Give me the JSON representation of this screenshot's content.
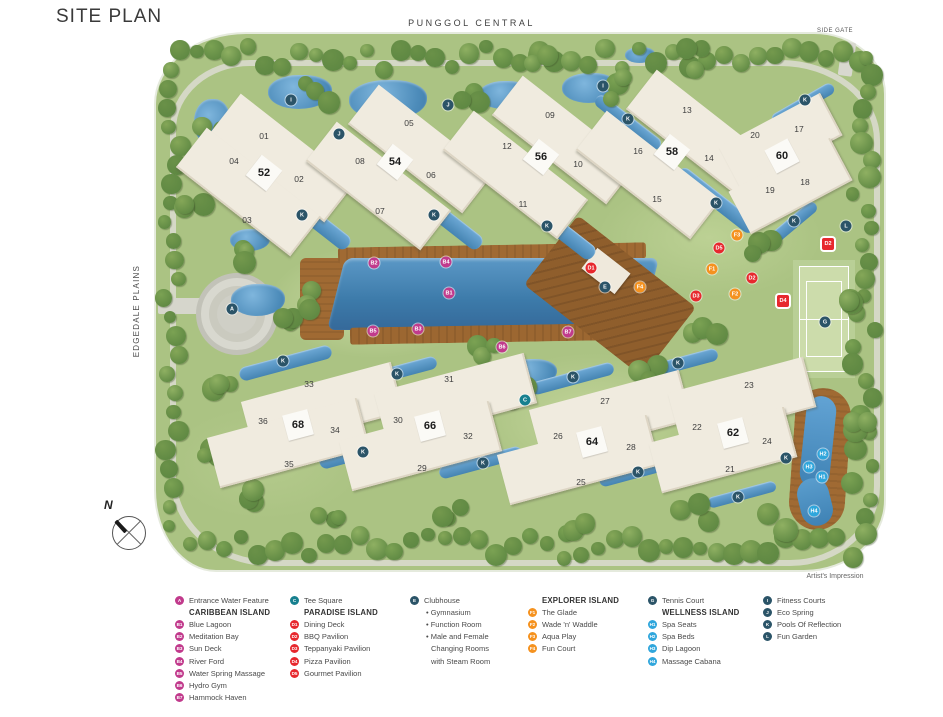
{
  "page": {
    "title": "SITE PLAN",
    "artist_note": "Artist's Impression"
  },
  "roads": {
    "top": "PUNGGOL CENTRAL",
    "left": "EDGEDALE PLAINS",
    "side_gate": "SIDE GATE"
  },
  "compass": {
    "label": "N"
  },
  "colors": {
    "pink": "#C13A8C",
    "red": "#E7282E",
    "orange": "#F5921F",
    "lightblue": "#2FA6DC",
    "teal": "#17808F",
    "dark": "#2B5468"
  },
  "map": {
    "buildings": [
      {
        "label": "01",
        "x": 264,
        "y": 136
      },
      {
        "label": "02",
        "x": 299,
        "y": 179
      },
      {
        "label": "03",
        "x": 247,
        "y": 220
      },
      {
        "label": "04",
        "x": 234,
        "y": 161
      },
      {
        "label": "05",
        "x": 409,
        "y": 123
      },
      {
        "label": "06",
        "x": 431,
        "y": 175
      },
      {
        "label": "07",
        "x": 380,
        "y": 211
      },
      {
        "label": "08",
        "x": 360,
        "y": 161
      },
      {
        "label": "09",
        "x": 550,
        "y": 115
      },
      {
        "label": "10",
        "x": 578,
        "y": 164
      },
      {
        "label": "11",
        "x": 523,
        "y": 204
      },
      {
        "label": "12",
        "x": 507,
        "y": 146
      },
      {
        "label": "13",
        "x": 687,
        "y": 110
      },
      {
        "label": "14",
        "x": 709,
        "y": 158
      },
      {
        "label": "15",
        "x": 657,
        "y": 199
      },
      {
        "label": "16",
        "x": 638,
        "y": 151
      },
      {
        "label": "17",
        "x": 799,
        "y": 129
      },
      {
        "label": "18",
        "x": 805,
        "y": 182
      },
      {
        "label": "19",
        "x": 770,
        "y": 190
      },
      {
        "label": "20",
        "x": 755,
        "y": 135
      },
      {
        "label": "21",
        "x": 730,
        "y": 469
      },
      {
        "label": "22",
        "x": 697,
        "y": 427
      },
      {
        "label": "23",
        "x": 749,
        "y": 385
      },
      {
        "label": "24",
        "x": 767,
        "y": 441
      },
      {
        "label": "25",
        "x": 581,
        "y": 482
      },
      {
        "label": "26",
        "x": 558,
        "y": 436
      },
      {
        "label": "27",
        "x": 605,
        "y": 401
      },
      {
        "label": "28",
        "x": 631,
        "y": 447
      },
      {
        "label": "29",
        "x": 422,
        "y": 468
      },
      {
        "label": "30",
        "x": 398,
        "y": 420
      },
      {
        "label": "31",
        "x": 449,
        "y": 379
      },
      {
        "label": "32",
        "x": 468,
        "y": 436
      },
      {
        "label": "33",
        "x": 309,
        "y": 384
      },
      {
        "label": "34",
        "x": 335,
        "y": 430
      },
      {
        "label": "35",
        "x": 289,
        "y": 464
      },
      {
        "label": "36",
        "x": 263,
        "y": 421
      }
    ],
    "bold_blocks": [
      {
        "label": "52",
        "x": 264,
        "y": 173
      },
      {
        "label": "54",
        "x": 395,
        "y": 162
      },
      {
        "label": "56",
        "x": 541,
        "y": 157
      },
      {
        "label": "58",
        "x": 672,
        "y": 152
      },
      {
        "label": "60",
        "x": 782,
        "y": 156
      },
      {
        "label": "62",
        "x": 733,
        "y": 433
      },
      {
        "label": "64",
        "x": 592,
        "y": 442
      },
      {
        "label": "66",
        "x": 430,
        "y": 426
      },
      {
        "label": "68",
        "x": 298,
        "y": 425
      }
    ],
    "blocks": [
      {
        "x": 282,
        "y": 158,
        "w": 145,
        "h": 50,
        "r": 38
      },
      {
        "x": 248,
        "y": 192,
        "w": 145,
        "h": 50,
        "r": 38
      },
      {
        "x": 420,
        "y": 149,
        "w": 145,
        "h": 50,
        "r": 38
      },
      {
        "x": 378,
        "y": 186,
        "w": 145,
        "h": 50,
        "r": 38
      },
      {
        "x": 564,
        "y": 140,
        "w": 145,
        "h": 50,
        "r": 38
      },
      {
        "x": 515,
        "y": 175,
        "w": 145,
        "h": 50,
        "r": 38
      },
      {
        "x": 698,
        "y": 134,
        "w": 145,
        "h": 50,
        "r": 38
      },
      {
        "x": 648,
        "y": 175,
        "w": 145,
        "h": 50,
        "r": 38
      },
      {
        "x": 780,
        "y": 141,
        "w": 115,
        "h": 48,
        "r": -28
      },
      {
        "x": 790,
        "y": 186,
        "w": 115,
        "h": 48,
        "r": -28
      },
      {
        "x": 322,
        "y": 407,
        "w": 155,
        "h": 52,
        "r": -15
      },
      {
        "x": 288,
        "y": 443,
        "w": 155,
        "h": 52,
        "r": -15
      },
      {
        "x": 455,
        "y": 398,
        "w": 155,
        "h": 52,
        "r": -15
      },
      {
        "x": 420,
        "y": 446,
        "w": 155,
        "h": 52,
        "r": -15
      },
      {
        "x": 610,
        "y": 415,
        "w": 155,
        "h": 52,
        "r": -15
      },
      {
        "x": 578,
        "y": 460,
        "w": 155,
        "h": 52,
        "r": -15
      },
      {
        "x": 742,
        "y": 400,
        "w": 140,
        "h": 52,
        "r": -15
      },
      {
        "x": 723,
        "y": 450,
        "w": 140,
        "h": 52,
        "r": -15
      }
    ],
    "badges": [
      {
        "label": "A",
        "color": "dark",
        "x": 232,
        "y": 309
      },
      {
        "label": "B1",
        "color": "pink",
        "x": 449,
        "y": 293
      },
      {
        "label": "B2",
        "color": "pink",
        "x": 374,
        "y": 263
      },
      {
        "label": "B3",
        "color": "pink",
        "x": 418,
        "y": 329
      },
      {
        "label": "B4",
        "color": "pink",
        "x": 446,
        "y": 262
      },
      {
        "label": "B5",
        "color": "pink",
        "x": 373,
        "y": 331
      },
      {
        "label": "B6",
        "color": "pink",
        "x": 502,
        "y": 347
      },
      {
        "label": "B7",
        "color": "pink",
        "x": 568,
        "y": 332
      },
      {
        "label": "C",
        "color": "teal",
        "x": 525,
        "y": 400
      },
      {
        "label": "D1",
        "color": "red",
        "x": 591,
        "y": 268
      },
      {
        "label": "D2",
        "color": "red",
        "x": 752,
        "y": 278
      },
      {
        "label": "D2",
        "color": "red",
        "x": 828,
        "y": 244,
        "shape": "square"
      },
      {
        "label": "D3",
        "color": "red",
        "x": 696,
        "y": 296
      },
      {
        "label": "D4",
        "color": "red",
        "x": 783,
        "y": 301,
        "shape": "square"
      },
      {
        "label": "D5",
        "color": "red",
        "x": 719,
        "y": 248
      },
      {
        "label": "E",
        "color": "dark",
        "x": 605,
        "y": 287
      },
      {
        "label": "F1",
        "color": "orange",
        "x": 712,
        "y": 269
      },
      {
        "label": "F2",
        "color": "orange",
        "x": 735,
        "y": 294
      },
      {
        "label": "F3",
        "color": "orange",
        "x": 737,
        "y": 235
      },
      {
        "label": "F4",
        "color": "orange",
        "x": 640,
        "y": 287
      },
      {
        "label": "G",
        "color": "dark",
        "x": 825,
        "y": 322
      },
      {
        "label": "H1",
        "color": "lightblue",
        "x": 822,
        "y": 477
      },
      {
        "label": "H2",
        "color": "lightblue",
        "x": 823,
        "y": 454
      },
      {
        "label": "H3",
        "color": "lightblue",
        "x": 809,
        "y": 467
      },
      {
        "label": "H4",
        "color": "lightblue",
        "x": 814,
        "y": 511
      },
      {
        "label": "I",
        "color": "dark",
        "x": 291,
        "y": 100
      },
      {
        "label": "I",
        "color": "dark",
        "x": 603,
        "y": 86
      },
      {
        "label": "J",
        "color": "dark",
        "x": 339,
        "y": 134
      },
      {
        "label": "J",
        "color": "dark",
        "x": 448,
        "y": 105
      },
      {
        "label": "K",
        "color": "dark",
        "x": 302,
        "y": 215
      },
      {
        "label": "K",
        "color": "dark",
        "x": 434,
        "y": 215
      },
      {
        "label": "K",
        "color": "dark",
        "x": 547,
        "y": 226
      },
      {
        "label": "K",
        "color": "dark",
        "x": 628,
        "y": 119
      },
      {
        "label": "K",
        "color": "dark",
        "x": 716,
        "y": 203
      },
      {
        "label": "K",
        "color": "dark",
        "x": 805,
        "y": 100
      },
      {
        "label": "K",
        "color": "dark",
        "x": 794,
        "y": 221
      },
      {
        "label": "K",
        "color": "dark",
        "x": 283,
        "y": 361
      },
      {
        "label": "K",
        "color": "dark",
        "x": 397,
        "y": 374
      },
      {
        "label": "K",
        "color": "dark",
        "x": 363,
        "y": 452
      },
      {
        "label": "K",
        "color": "dark",
        "x": 483,
        "y": 463
      },
      {
        "label": "K",
        "color": "dark",
        "x": 573,
        "y": 377
      },
      {
        "label": "K",
        "color": "dark",
        "x": 678,
        "y": 363
      },
      {
        "label": "K",
        "color": "dark",
        "x": 638,
        "y": 472
      },
      {
        "label": "K",
        "color": "dark",
        "x": 786,
        "y": 458
      },
      {
        "label": "K",
        "color": "dark",
        "x": 738,
        "y": 497
      },
      {
        "label": "L",
        "color": "dark",
        "x": 846,
        "y": 226
      }
    ]
  },
  "legend": {
    "columns": [
      {
        "left": 175,
        "rows": [
          {
            "type": "item",
            "badge": "A",
            "color": "pink",
            "label": "Entrance Water Feature"
          },
          {
            "type": "header",
            "label": "CARIBBEAN ISLAND"
          },
          {
            "type": "item",
            "badge": "B1",
            "color": "pink",
            "label": "Blue Lagoon"
          },
          {
            "type": "item",
            "badge": "B2",
            "color": "pink",
            "label": "Meditation Bay"
          },
          {
            "type": "item",
            "badge": "B3",
            "color": "pink",
            "label": "Sun Deck"
          },
          {
            "type": "item",
            "badge": "B4",
            "color": "pink",
            "label": "River Ford"
          },
          {
            "type": "item",
            "badge": "B5",
            "color": "pink",
            "label": "Water Spring Massage"
          },
          {
            "type": "item",
            "badge": "B6",
            "color": "pink",
            "label": "Hydro Gym"
          },
          {
            "type": "item",
            "badge": "B7",
            "color": "pink",
            "label": "Hammock Haven"
          }
        ]
      },
      {
        "left": 290,
        "rows": [
          {
            "type": "item",
            "badge": "C",
            "color": "teal",
            "label": "Tee Square"
          },
          {
            "type": "header",
            "label": "PARADISE ISLAND"
          },
          {
            "type": "item",
            "badge": "D1",
            "color": "red",
            "label": "Dining Deck"
          },
          {
            "type": "item",
            "badge": "D2",
            "color": "red",
            "label": "BBQ Pavilion"
          },
          {
            "type": "item",
            "badge": "D3",
            "color": "red",
            "label": "Teppanyaki Pavilion"
          },
          {
            "type": "item",
            "badge": "D4",
            "color": "red",
            "label": "Pizza Pavilion"
          },
          {
            "type": "item",
            "badge": "D5",
            "color": "red",
            "label": "Gourmet Pavilion"
          }
        ]
      },
      {
        "left": 410,
        "rows": [
          {
            "type": "item",
            "badge": "E",
            "color": "dark",
            "label": "Clubhouse"
          },
          {
            "type": "bullet",
            "label": "Gymnasium"
          },
          {
            "type": "bullet",
            "label": "Function Room"
          },
          {
            "type": "bullet",
            "label": "Male and Female"
          },
          {
            "type": "cont",
            "label": "Changing Rooms"
          },
          {
            "type": "cont",
            "label": "with Steam Room"
          }
        ]
      },
      {
        "left": 528,
        "rows": [
          {
            "type": "header",
            "label": "EXPLORER ISLAND"
          },
          {
            "type": "item",
            "badge": "F1",
            "color": "orange",
            "label": "The Glade"
          },
          {
            "type": "item",
            "badge": "F2",
            "color": "orange",
            "label": "Wade 'n' Waddle"
          },
          {
            "type": "item",
            "badge": "F3",
            "color": "orange",
            "label": "Aqua Play"
          },
          {
            "type": "item",
            "badge": "F4",
            "color": "orange",
            "label": "Fun Court"
          }
        ]
      },
      {
        "left": 648,
        "rows": [
          {
            "type": "item",
            "badge": "G",
            "color": "dark",
            "label": "Tennis Court"
          },
          {
            "type": "header",
            "label": "WELLNESS ISLAND"
          },
          {
            "type": "item",
            "badge": "H1",
            "color": "lightblue",
            "label": "Spa Seats"
          },
          {
            "type": "item",
            "badge": "H2",
            "color": "lightblue",
            "label": "Spa Beds"
          },
          {
            "type": "item",
            "badge": "H3",
            "color": "lightblue",
            "label": "Dip Lagoon"
          },
          {
            "type": "item",
            "badge": "H4",
            "color": "lightblue",
            "label": "Massage Cabana"
          }
        ]
      },
      {
        "left": 763,
        "rows": [
          {
            "type": "item",
            "badge": "I",
            "color": "dark",
            "label": "Fitness Courts"
          },
          {
            "type": "item",
            "badge": "J",
            "color": "dark",
            "label": "Eco Spring"
          },
          {
            "type": "item",
            "badge": "K",
            "color": "dark",
            "label": "Pools Of Reflection"
          },
          {
            "type": "item",
            "badge": "L",
            "color": "dark",
            "label": "Fun Garden"
          }
        ]
      }
    ]
  }
}
